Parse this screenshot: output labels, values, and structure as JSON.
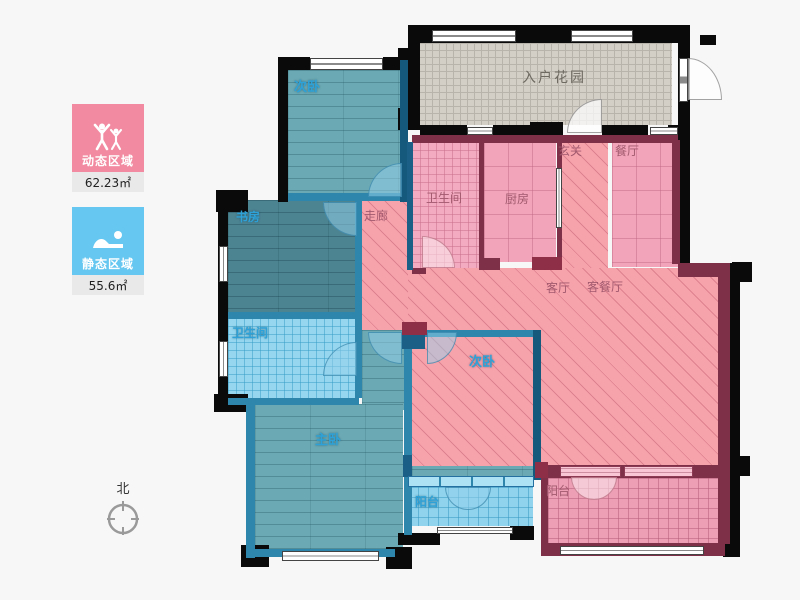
{
  "legend": {
    "dynamic": {
      "label": "动态区域",
      "area": "62.23㎡",
      "color": "#f28ba1",
      "icon": "people-icon"
    },
    "static": {
      "label": "静态区域",
      "area": "55.6㎡",
      "color": "#66c7f0",
      "icon": "sleeping-icon"
    }
  },
  "compass": {
    "label": "北"
  },
  "rooms": {
    "garden": {
      "label": "入户花园"
    },
    "bedroom_top": {
      "label": "次卧"
    },
    "study": {
      "label": "书房"
    },
    "bath_blue": {
      "label": "卫生间"
    },
    "master": {
      "label": "主卧"
    },
    "corridor": {
      "label": "走廊"
    },
    "bath_pink": {
      "label": "卫生间"
    },
    "kitchen": {
      "label": "厨房"
    },
    "foyer": {
      "label": "玄关"
    },
    "dining": {
      "label": "餐厅"
    },
    "living": {
      "label": "客厅"
    },
    "living_dining": {
      "label": "客餐厅"
    },
    "bedroom_mid": {
      "label": "次卧"
    },
    "balcony_blue": {
      "label": "阳台"
    },
    "balcony_pink": {
      "label": "阳台"
    }
  },
  "palette": {
    "dynamic_pink": "#f28ba1",
    "static_blue": "#66c7f0",
    "wall_black": "#0a0a0a",
    "wall_maroon": "#7e3048",
    "wall_teal": "#2e86ad",
    "floor_teal_wood": "#6ba9b4",
    "floor_pink_hatch": "#f7a3ac",
    "floor_garden_gray": "#d3cec6",
    "label_blue": "#2ea2d8",
    "label_pink": "#a2596e"
  }
}
